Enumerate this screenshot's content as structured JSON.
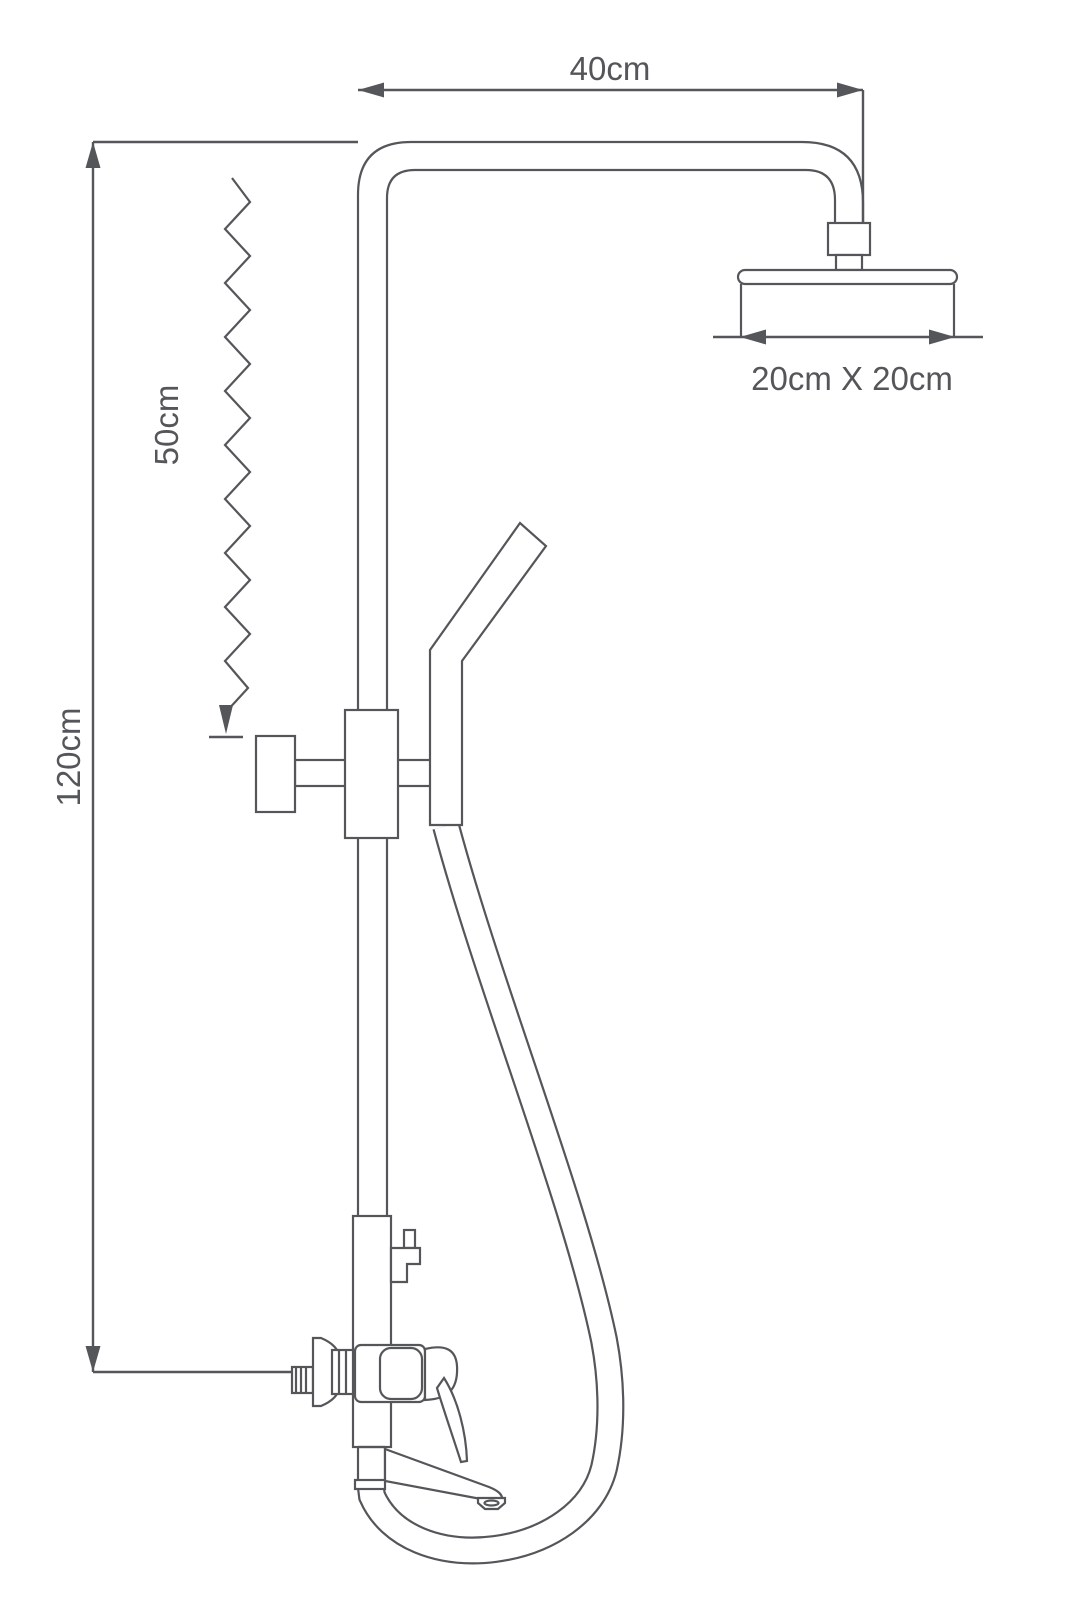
{
  "page": {
    "background": "#ffffff"
  },
  "diagram": {
    "type": "technical-line-drawing",
    "subject": "wall-mounted shower column with overhead shower head, hand shower, mixer valve and tub spout",
    "line_color": "#55565a",
    "dimensions": {
      "arm_width": {
        "label": "40cm"
      },
      "head_size": {
        "label": "20cm X 20cm"
      },
      "hose_drop": {
        "label": "50cm"
      },
      "total_height": {
        "label": "120cm"
      }
    },
    "components": [
      "shower arm",
      "overhead shower head",
      "riser pipe",
      "hand shower",
      "slider bracket",
      "slider knob",
      "shower hose",
      "diverter knob",
      "mixer valve body",
      "mixer lever handle",
      "wall flange",
      "hex nut",
      "threaded wall inlet",
      "tub spout",
      "spout aerator"
    ]
  }
}
